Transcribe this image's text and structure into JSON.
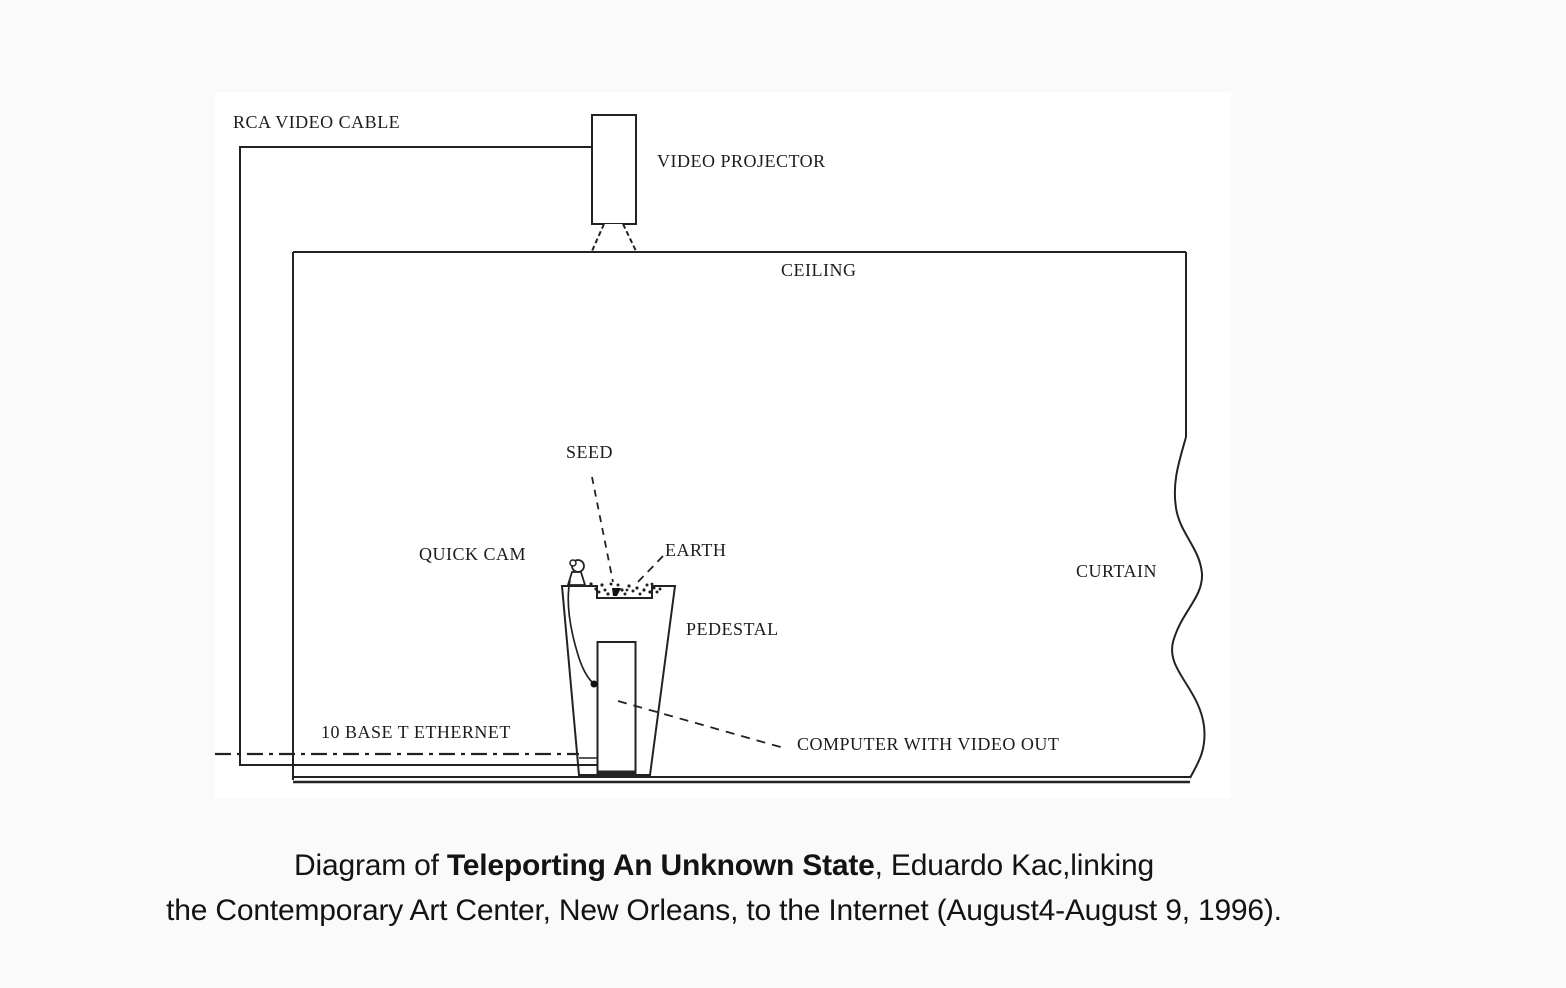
{
  "colors": {
    "page_bg": "#fafafa",
    "diagram_bg": "#ffffff",
    "line": "#222222",
    "label_text": "#1c1c1c",
    "caption_text": "#131313"
  },
  "diagram": {
    "labels": {
      "rca": "RCA VIDEO CABLE",
      "projector": "VIDEO PROJECTOR",
      "ceiling": "CEILING",
      "seed": "SEED",
      "quick_cam": "QUICK CAM",
      "earth": "EARTH",
      "pedestal": "PEDESTAL",
      "curtain": "CURTAIN",
      "ethernet": "10 BASE T ETHERNET",
      "computer": "COMPUTER WITH VIDEO OUT"
    }
  },
  "caption": {
    "line1_prefix": "Diagram of ",
    "line1_title": "Teleporting An Unknown State",
    "line1_suffix": ", Eduardo Kac,linking",
    "line2": "the Contemporary Art Center, New Orleans, to the Internet (August4-August 9, 1996)."
  }
}
